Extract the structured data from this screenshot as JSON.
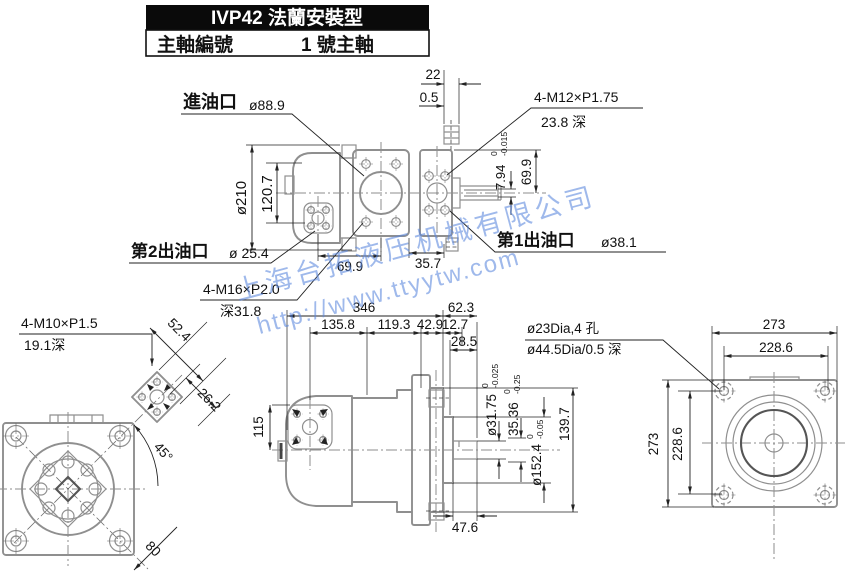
{
  "title_block": {
    "header": "IVP42 法蘭安裝型",
    "row_label": "主軸編號",
    "row_value": "1 號主軸"
  },
  "watermark": {
    "line1": "上海台拓液压机械有限公司",
    "line2": "http://www.ttyytw.com",
    "color": "#5b87dd"
  },
  "top_view": {
    "inlet_label": "進油口",
    "inlet_dia": "ø88.9",
    "dim_22": "22",
    "dim_0_5": "0.5",
    "m12_spec": "4-M12×P1.75",
    "m12_depth": "23.8 深",
    "key_width": "7.94",
    "key_tol_u": "0",
    "key_tol_l": "-0.015",
    "dim_69_9_right": "69.9",
    "body_dia": "ø210",
    "dim_120_7": "120.7",
    "outlet2_label": "第2出油口",
    "outlet2_dia": "ø 25.4",
    "m16_spec": "4-M16×P2.0",
    "m16_depth": "深31.8",
    "dim_69_9_bottom": "69.9",
    "dim_35_7": "35.7",
    "outlet1_label": "第1出油口",
    "outlet1_dia": "ø38.1"
  },
  "front_view": {
    "m10_spec": "4-M10×P1.5",
    "m10_depth": "19.1深",
    "dim_52_4": "52.4",
    "dim_26_2": "26.2",
    "angle_45": "45°",
    "dim_80": "80"
  },
  "side_view": {
    "dim_346": "346",
    "dim_62_3": "62.3",
    "dim_135_8": "135.8",
    "dim_119_3": "119.3",
    "dim_42_9": "42.9",
    "dim_12_7": "12.7",
    "dim_28_5": "28.5",
    "dim_115": "115",
    "shaft_dia": "ø31.75",
    "shaft_tol_u": "0",
    "shaft_tol_l": "-0.025",
    "key_h": "35.36",
    "key_h_tol_u": "0",
    "key_h_tol_l": "-0.25",
    "pilot_dia": "ø152.4",
    "pilot_tol_u": "0",
    "pilot_tol_l": "-0.05",
    "dim_139_7": "139.7",
    "dim_47_6": "47.6"
  },
  "rear_view": {
    "dim_273_top": "273",
    "dim_228_6_top": "228.6",
    "dim_273_left": "273",
    "dim_228_6_left": "228.6",
    "holes_spec": "ø23Dia,4 孔",
    "recess_spec": "ø44.5Dia/0.5 深"
  }
}
